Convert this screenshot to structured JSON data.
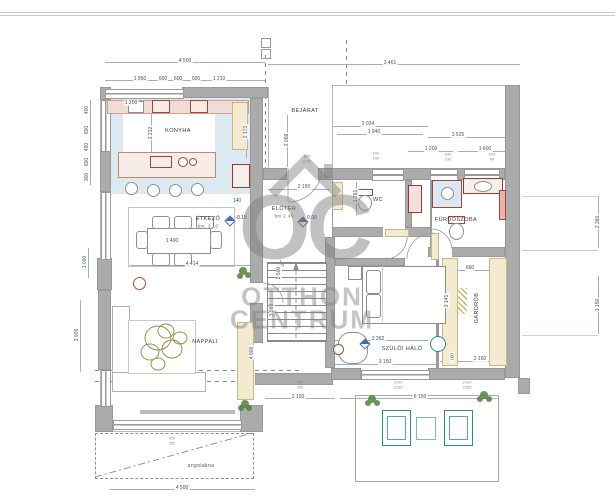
{
  "watermark": {
    "monogram": "OC",
    "line1": "OTTHON",
    "line2": "CENTRUM"
  },
  "rooms": {
    "konyha": "KONYHA",
    "bejarat": "BEJÁRAT",
    "eloter": "ELŐTÉR",
    "eloter_h": "bm 2.45",
    "etkezo": "ÉTKEZŐ",
    "etkezo_h": "bm. 3.10",
    "nappali": "NAPPALI",
    "wc": "WC",
    "furdoszoba": "FÜRDŐSZOBA",
    "gardrob": "GARDRÓB",
    "haloszoba": "SZÜLŐI HÁLÓ",
    "angolakna": "angolakna",
    "stairs": "UP"
  },
  "levels": {
    "zero": "0.00",
    "minus": "-0.15"
  },
  "dims": {
    "top_left": "4 500",
    "top_right": "3 461",
    "k1": "1 950",
    "k2": "600",
    "k3": "600",
    "k4": "500",
    "k5": "1 210",
    "k6": "1 200",
    "k7": "2 212",
    "k8": "2 173",
    "bej": "2 059",
    "n1": "2 024",
    "n2": "1 940",
    "n3": "3 525",
    "n4": "1 200",
    "n5": "1 600",
    "l1": "400",
    "l2": "600",
    "l3": "450",
    "l4": "600",
    "l5": "300",
    "l6": "1 000",
    "l7": "3 905",
    "w140": "140",
    "hall_w": "2 150",
    "wc_d": "1 791",
    "tbl": "1 400",
    "din": "4 414",
    "st": "2 500",
    "hall_v": "3 980",
    "liv_v": "4 000",
    "bed_a": "3 262",
    "bed_w": "3 150",
    "bed_b": "160",
    "gard_w": "2 160",
    "s1": "2 150",
    "s2": "6 150",
    "s3": "4 500",
    "g1": "660",
    "g2": "3 141",
    "r1": "2 360",
    "r2": "3 150"
  },
  "specs": {
    "n_a": "100\n240",
    "n_b": "900\n150",
    "n_c": "900\n90",
    "bej": "975\n2150",
    "s_l": "240\n250",
    "s_m": "2100\n2160",
    "s_r": "2410\n2160",
    "ang": "400\n250"
  }
}
